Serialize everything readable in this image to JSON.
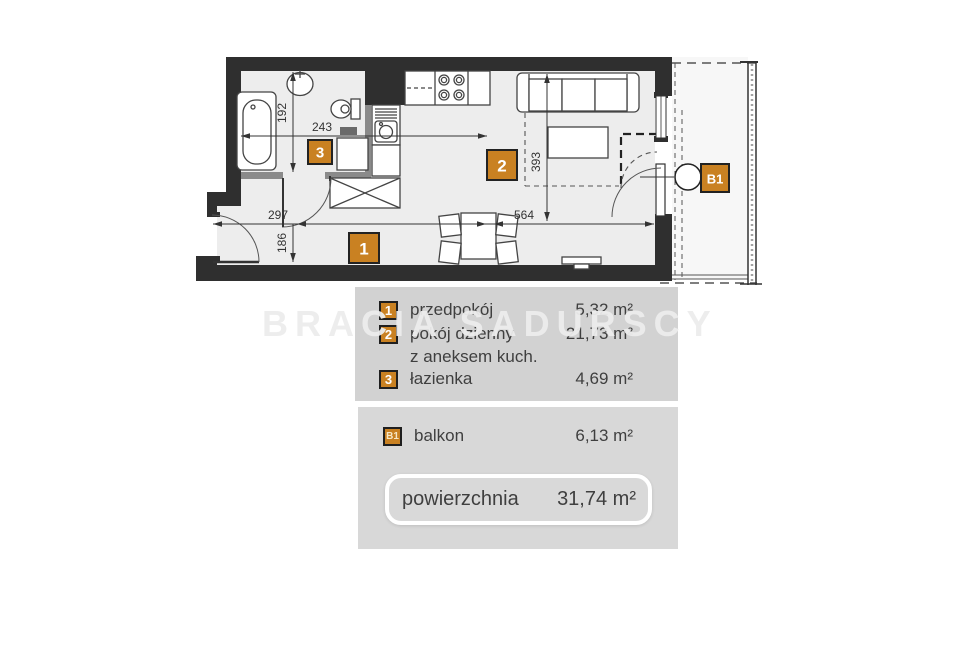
{
  "watermark": "BRACIA SADURSCY",
  "plan": {
    "room_badges": {
      "hall": "1",
      "living": "2",
      "bath": "3",
      "balcony": "B1"
    },
    "dimensions": {
      "bath_height": "192",
      "bath_width": "243",
      "hall_width": "297",
      "hall_height": "186",
      "living_width": "564",
      "living_height": "393"
    }
  },
  "legend": {
    "rooms": [
      {
        "badge": "1",
        "label": "przedpokój",
        "area": "5,32 m²"
      },
      {
        "badge": "2",
        "label": "pokój dzienny",
        "label_line2": "z aneksem kuch.",
        "area": "21,73 m²"
      },
      {
        "badge": "3",
        "label": "łazienka",
        "area": "4,69 m²"
      }
    ],
    "balcony": {
      "badge": "B1",
      "label": "balkon",
      "area": "6,13 m²"
    },
    "total": {
      "label": "powierzchnia",
      "area": "31,74 m²"
    }
  },
  "colors": {
    "badge_orange": "#c98122",
    "wall_dark": "#2f2f2f",
    "floor_gray": "#ededed",
    "panel_gray": "#d2d2d2",
    "panel_gray_light": "#d8d8d8"
  }
}
